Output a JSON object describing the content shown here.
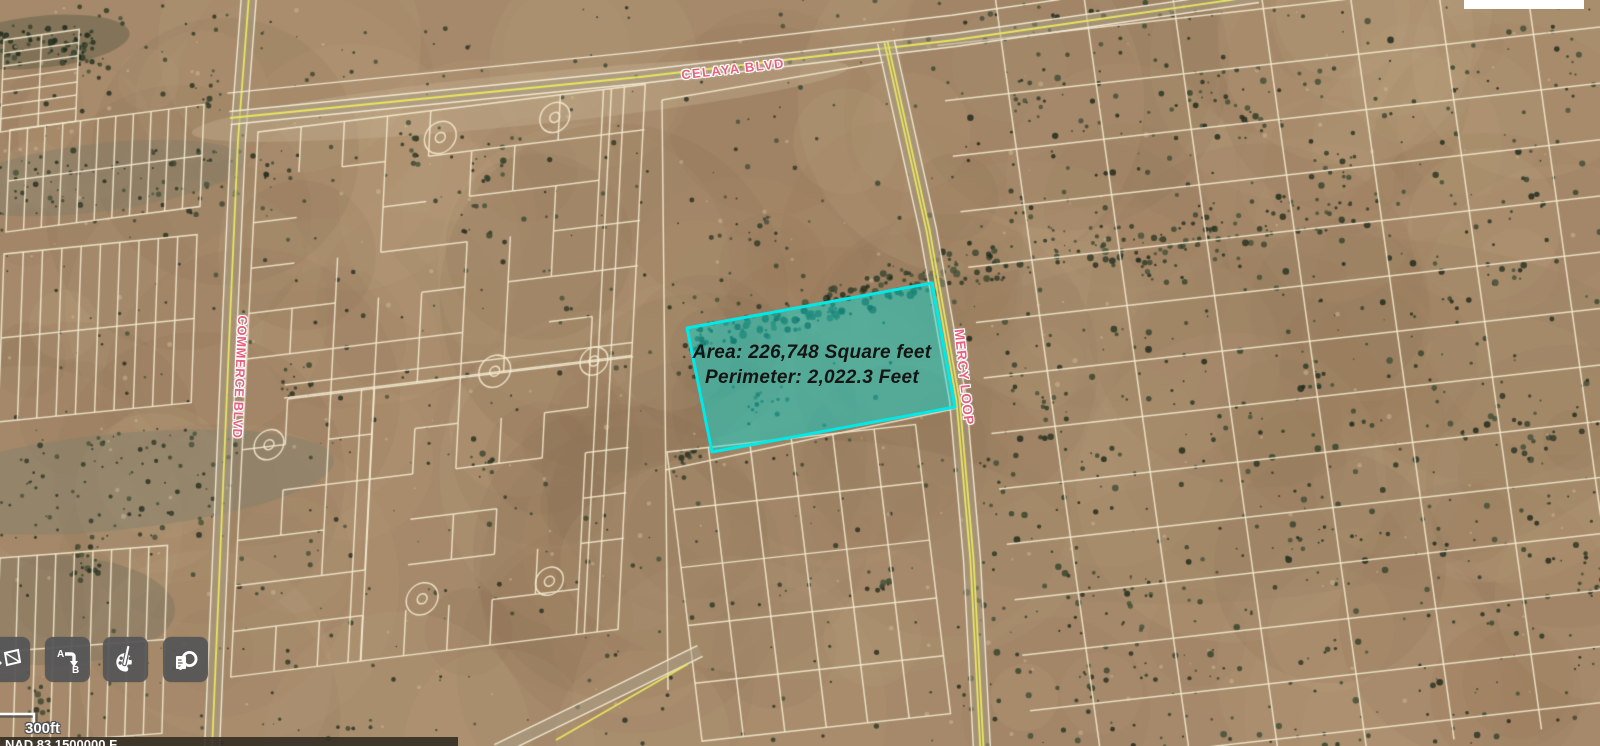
{
  "measurement": {
    "area_label": "Area: 226,748 Square feet",
    "perimeter_label": "Perimeter: 2,022.3 Feet"
  },
  "road_labels": {
    "celaya": "CELAYA BLVD",
    "commerce": "COMMERCE BLVD",
    "mercy": "MERCY LOOP"
  },
  "toolbar": {
    "buttons": [
      {
        "name": "basemap",
        "icon": "map-icon"
      },
      {
        "name": "directions",
        "icon": "a-to-b-icon",
        "label_a": "A",
        "label_b": "B"
      },
      {
        "name": "drawing-tools",
        "icon": "palette-icon"
      },
      {
        "name": "search-documents",
        "icon": "document-search-icon"
      }
    ]
  },
  "scale_bar": {
    "label": "300ft"
  },
  "status_bar": {
    "text": "NAD 83 1500000 F"
  },
  "colors": {
    "selection_fill": "rgba(0,224,220,0.45)",
    "selection_stroke": "#00e9e9",
    "road_label_pink": "#e8617f",
    "parcel_line": "rgba(245,235,208,0.88)",
    "road_yellow": "#e9e75f",
    "road_edge": "rgba(247,240,217,0.9)",
    "toolbar_button_bg": "rgba(85,85,87,0.93)"
  }
}
